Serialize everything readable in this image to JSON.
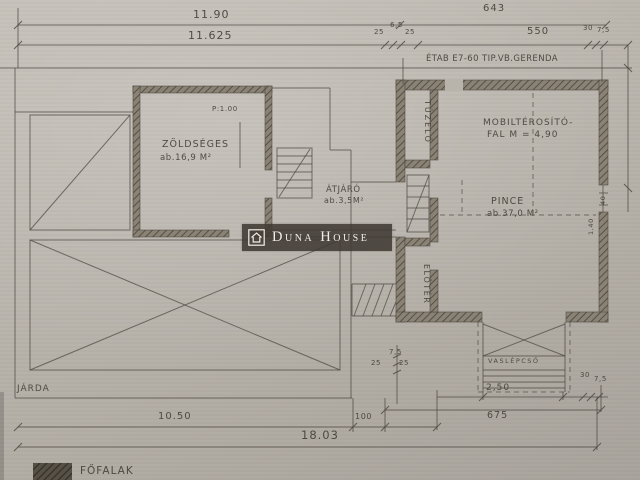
{
  "watermark": {
    "brand": "Duna House"
  },
  "notes": {
    "beam": "ÉTAB E7-60 TIP.VB.GERENDA"
  },
  "rooms": {
    "zoldseges": {
      "name": "ZÖLDSÉGES",
      "area": "ab.16,9 M²"
    },
    "atjaro": {
      "name": "ÁTJÁRÓ",
      "area": "ab.3,5M²"
    },
    "tuzelo": {
      "name": "TÜZELŐ"
    },
    "eloter": {
      "name": "ELŐTÉR"
    },
    "pince": {
      "name": "PINCE",
      "area": "ab.37,0 M²"
    },
    "partition": {
      "line1": "MOBILTÉROSÍTÓ-",
      "line2": "FAL  M = 4,90"
    },
    "pillar": "P:1.00"
  },
  "outside": {
    "jarda": "JÁRDA",
    "vaslepcso": "VASLÉPCSŐ"
  },
  "dims": {
    "top": {
      "total": "11.90",
      "inner": "11.625",
      "right_total": "643",
      "right_inner": "550",
      "t25a": "25",
      "t65": "6,5",
      "t25b": "25",
      "t30": "30",
      "t75": "7,5"
    },
    "bottom": {
      "left": "10.50",
      "step": "100",
      "total": "18.03",
      "stair": "2,50",
      "right": "675",
      "b30": "30",
      "b75": "7,5",
      "s75": "7,5",
      "s25a": "25",
      "s25b": "25"
    },
    "side": {
      "w140": "1,40",
      "w40": "40"
    }
  },
  "legend": {
    "walls": "FŐFALAK"
  },
  "colors": {
    "paper": "#b8b3ab",
    "ink": "#4c4740",
    "wall_hatch": "#8a8275",
    "watermark_bg": "#403a33"
  }
}
